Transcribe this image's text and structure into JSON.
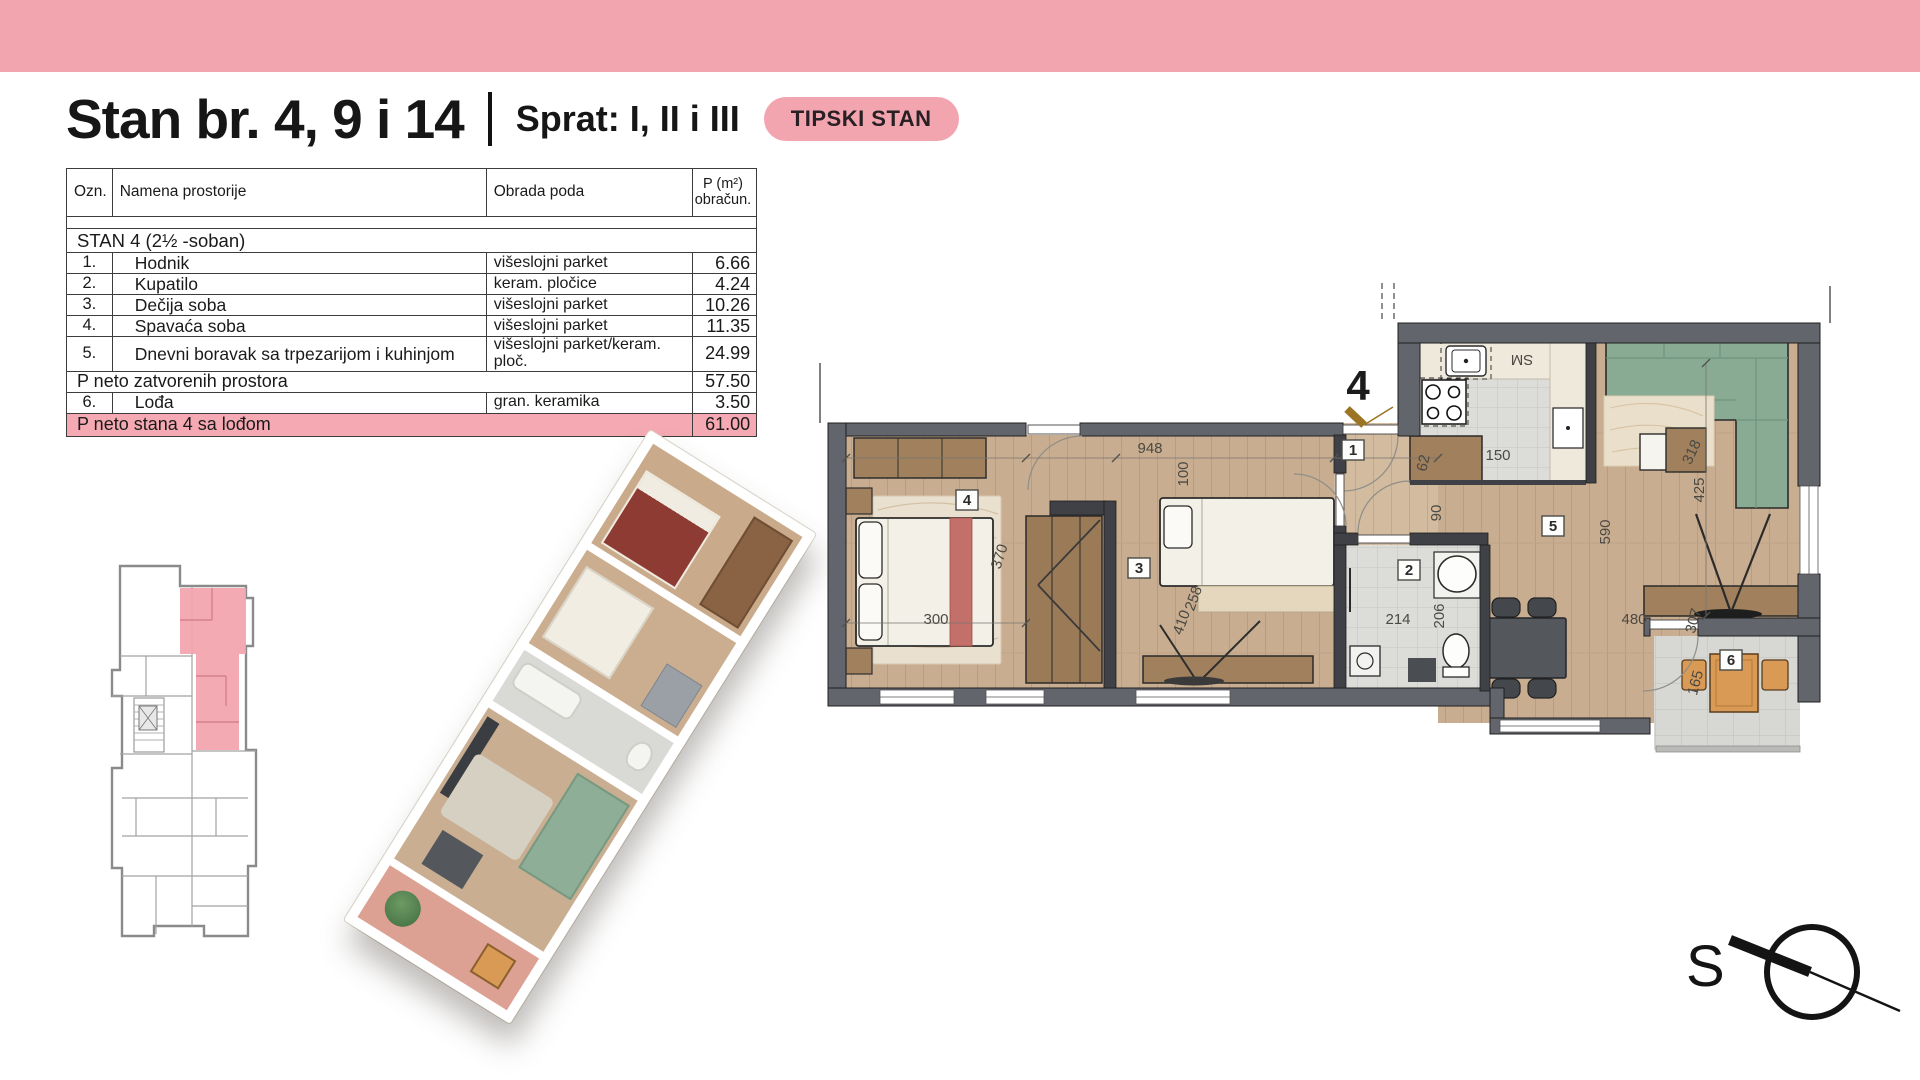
{
  "banner": {
    "color": "#f3a5af"
  },
  "header": {
    "title": "Stan br. 4, 9 i 14",
    "divider": "|",
    "subtitle": "Sprat: I, II i III",
    "badge": "TIPSKI STAN"
  },
  "area_table": {
    "col_ozn": "Ozn.",
    "col_name": "Namena prostorije",
    "col_floor": "Obrada poda",
    "col_area_line1": "P (m²)",
    "col_area_line2": "obračun.",
    "section_title": "STAN 4   (2½ -soban)",
    "rows": [
      {
        "ozn": "1.",
        "name": "Hodnik",
        "floor": "višeslojni parket",
        "area": "6.66"
      },
      {
        "ozn": "2.",
        "name": "Kupatilo",
        "floor": "keram. pločice",
        "area": "4.24"
      },
      {
        "ozn": "3.",
        "name": "Dečija soba",
        "floor": "višeslojni parket",
        "area": "10.26"
      },
      {
        "ozn": "4.",
        "name": "Spavaća soba",
        "floor": "višeslojni parket",
        "area": "11.35"
      },
      {
        "ozn": "5.",
        "name": "Dnevni boravak sa trpezarijom i kuhinjom",
        "floor": "višeslojni parket/keram. ploč.",
        "area": "24.99"
      }
    ],
    "subtotal_label": "P neto zatvorenih prostora",
    "subtotal_area": "57.50",
    "loggia_row": {
      "ozn": "6.",
      "name": "Lođa",
      "floor": "gran. keramika",
      "area": "3.50"
    },
    "total_label": "P neto stana 4 sa lođom",
    "total_area": "61.00"
  },
  "floor_plan": {
    "entrance_label": "4",
    "appliance_label": "SM",
    "badges": {
      "b1": "1",
      "b2": "2",
      "b3": "3",
      "b4": "4",
      "b5": "5",
      "b6": "6"
    },
    "dims": {
      "d948": "948",
      "d100": "100",
      "d62": "62",
      "d150": "150",
      "d90": "90",
      "d318": "318",
      "d425": "425",
      "d590": "590",
      "d300": "300",
      "d370": "370",
      "d410": "410",
      "d258": "258",
      "d214": "214",
      "d206": "206",
      "d480": "480",
      "d307": "307",
      "d165": "165"
    }
  },
  "compass": {
    "label": "S"
  }
}
